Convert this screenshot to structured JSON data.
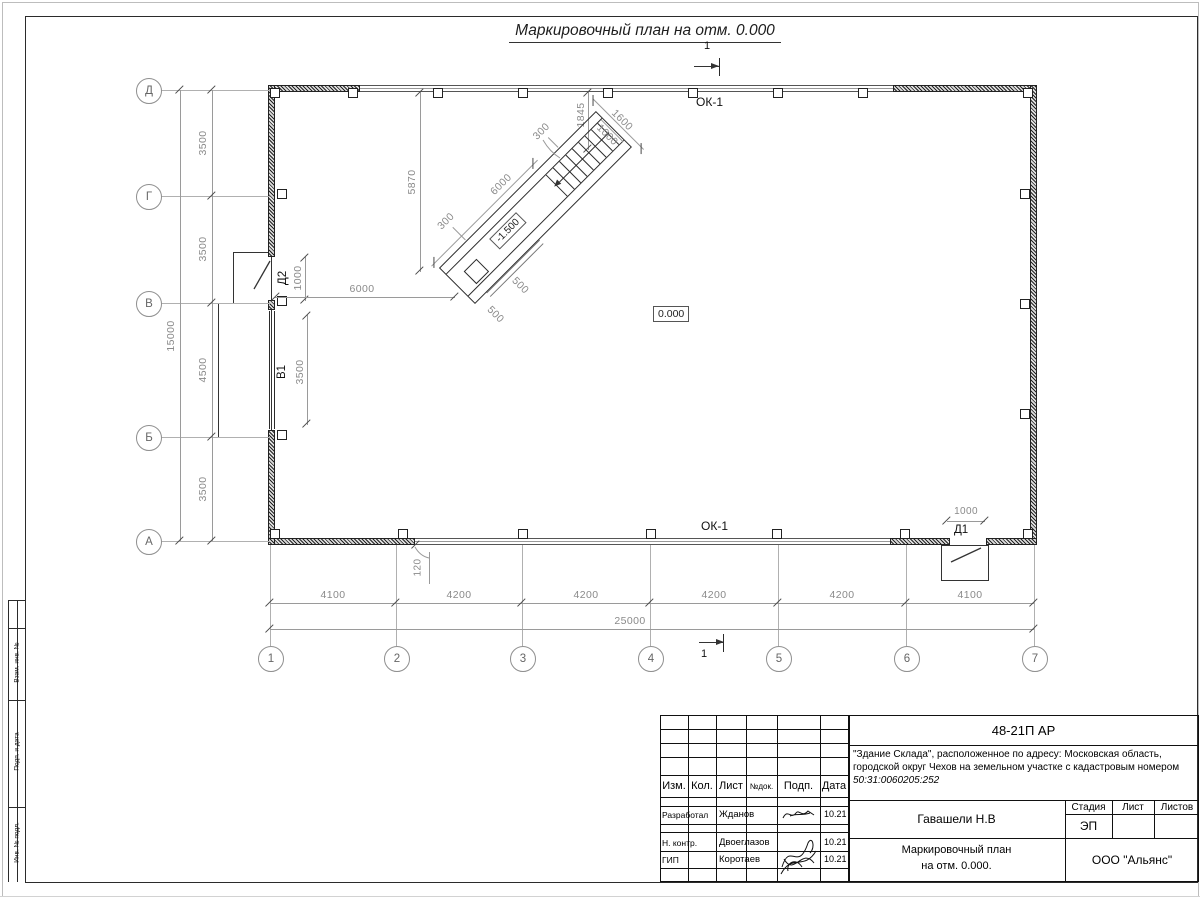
{
  "sheet": {
    "title": "Маркировочный план на отм. 0.000"
  },
  "section": {
    "top": "1",
    "bottom": "1"
  },
  "labels": {
    "ok1_top": "ОК-1",
    "ok1_bottom": "ОК-1",
    "level_zero": "0.000",
    "ramp_level": "-1.500",
    "door_d1": "Д1",
    "door_d2": "Д2",
    "gate_v1": "В1"
  },
  "axes": {
    "rows": [
      "Д",
      "Г",
      "В",
      "Б",
      "А"
    ],
    "row_dims": [
      "3500",
      "3500",
      "4500",
      "3500"
    ],
    "row_total": "15000",
    "cols": [
      "1",
      "2",
      "3",
      "4",
      "5",
      "6",
      "7"
    ],
    "col_dims": [
      "4100",
      "4200",
      "4200",
      "4200",
      "4200",
      "4100"
    ],
    "col_total": "25000"
  },
  "dims": {
    "d2_width": "1000",
    "v1_width": "3500",
    "wall_to_ramp": "6000",
    "top_to_ramp": "5870",
    "top_to_stair": "1845",
    "ramp_length": "6000",
    "ramp_width": "1600",
    "stair_width": "1000",
    "wall_a": "300",
    "wall_b": "300",
    "pit_a": "500",
    "pit_b": "500",
    "window_offset": "120",
    "d1_width": "1000"
  },
  "stamp": {
    "doc_number": "48-21П АР",
    "description": "\"Здание Склада\", расположенное по адресу: Московская область, городской округ Чехов на земельном участке с кадастровым номером",
    "cadastre": "50:31:0060205:252",
    "col_izm": "Изм.",
    "col_kol": "Кол.",
    "col_list": "Лист",
    "col_ndok": "№док.",
    "col_podp": "Подп.",
    "col_data": "Дата",
    "row1_role": "Разработал",
    "row1_name": "Жданов",
    "row1_date": "10.21",
    "row2_role": "Н. контр.",
    "row2_name": "Двоеглазов",
    "row2_date": "10.21",
    "row3_role": "ГИП",
    "row3_name": "Коротаев",
    "row3_date": "10.21",
    "author": "Гавашели Н.В",
    "stage_label": "Стадия",
    "list_label": "Лист",
    "listov_label": "Листов",
    "stage": "ЭП",
    "sheet_name_1": "Маркировочный план",
    "sheet_name_2": "на отм. 0.000.",
    "company": "ООО \"Альянс\""
  },
  "side_stamp": {
    "s1": "Взам. инв. №",
    "s2": "Подп. и дата",
    "s3": "Инв. № подл."
  }
}
